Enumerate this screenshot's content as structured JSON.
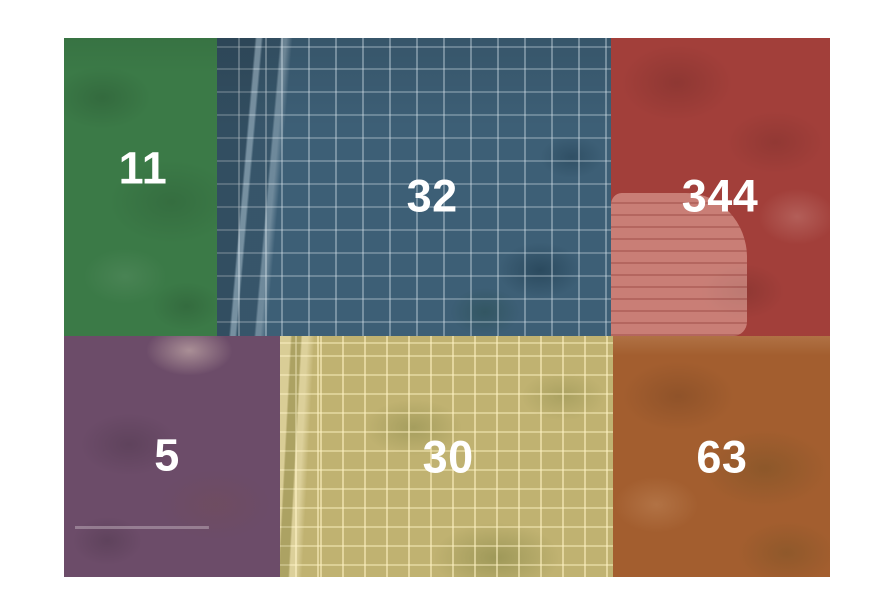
{
  "figure": {
    "background_color": "#ffffff",
    "map": {
      "kind": "aerial-imagery-tile-map",
      "label_color": "#ffffff",
      "regions": [
        {
          "position": "top-left",
          "value": "11",
          "color": "#3B7A47",
          "terrain": "rural-green-field"
        },
        {
          "position": "top-middle",
          "value": "32",
          "color": "#3D5F76",
          "terrain": "town-street-grid-with-highway"
        },
        {
          "position": "top-right",
          "value": "344",
          "color": "#A23F3A",
          "terrain": "rural-with-subdivision"
        },
        {
          "position": "bottom-left",
          "value": "5",
          "color": "#6C4C69",
          "terrain": "rural-field-with-airstrip"
        },
        {
          "position": "bottom-middle",
          "value": "30",
          "color": "#C0B271",
          "terrain": "dense-suburb-grid-with-highway"
        },
        {
          "position": "bottom-right",
          "value": "63",
          "color": "#A35E2F",
          "terrain": "rural-brown-field"
        }
      ]
    }
  }
}
